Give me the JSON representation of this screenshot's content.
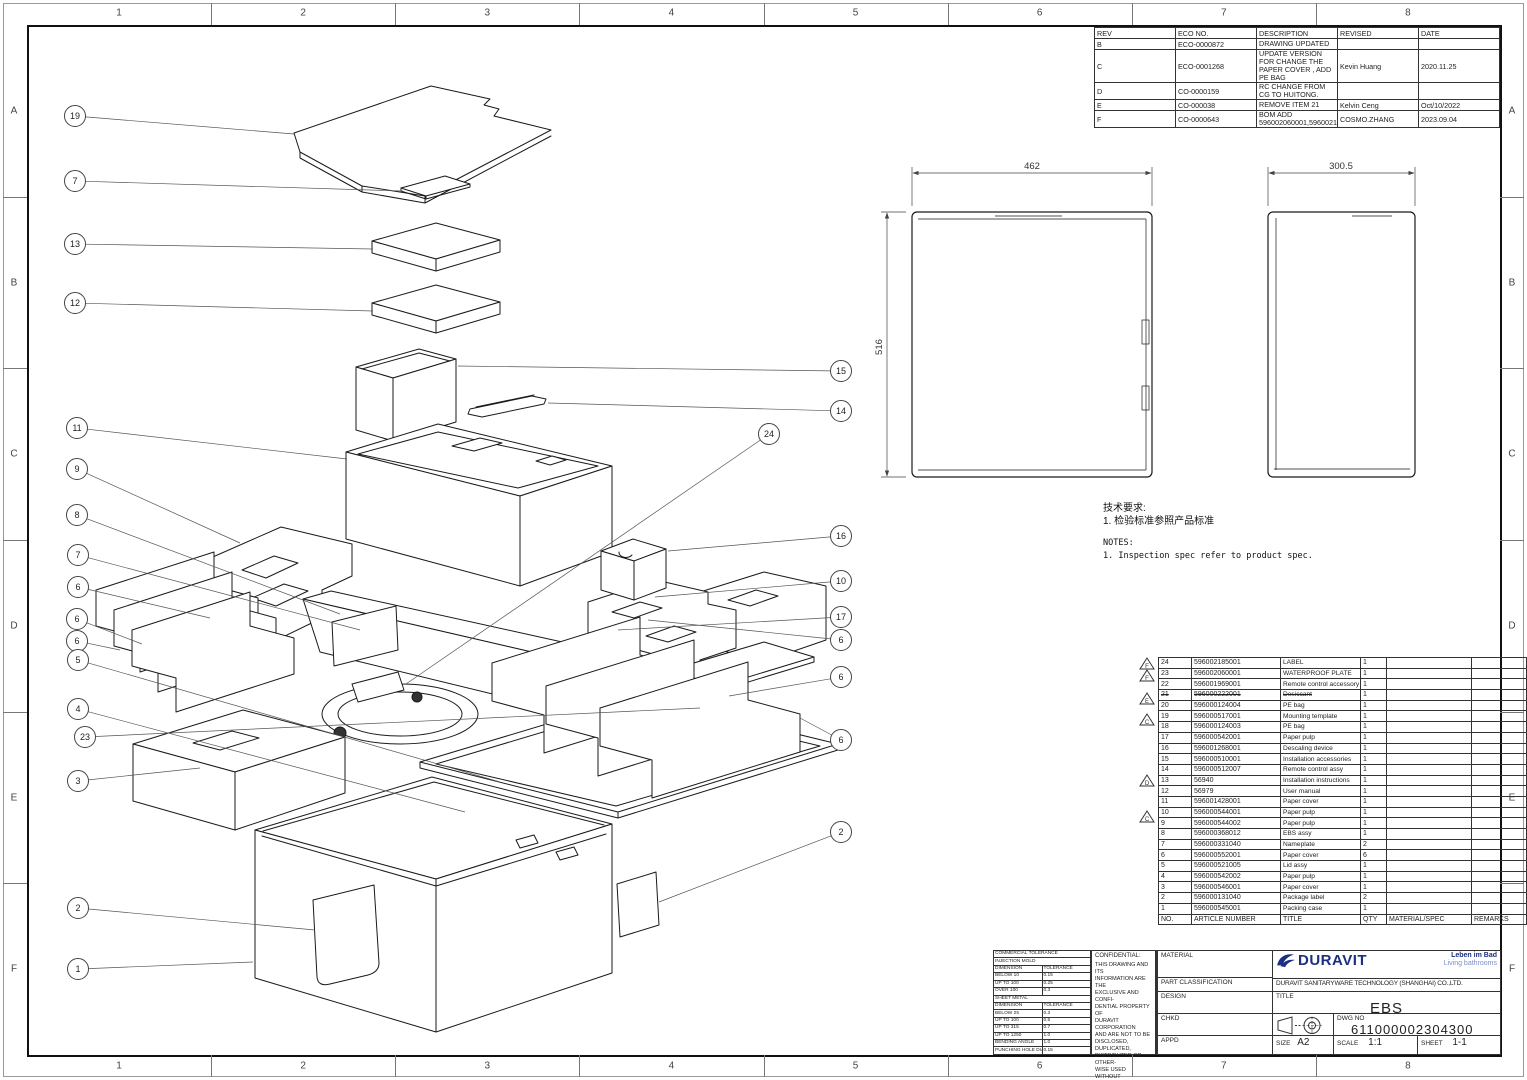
{
  "sheet": {
    "grid": {
      "cols": [
        "1",
        "2",
        "3",
        "4",
        "5",
        "6",
        "7",
        "8"
      ],
      "rows": [
        "A",
        "B",
        "C",
        "D",
        "E",
        "F"
      ]
    },
    "revisions": {
      "headers": [
        "REV",
        "ECO NO.",
        "DESCRIPTION",
        "REVISED",
        "DATE"
      ],
      "rows": [
        [
          "B",
          "ECO-0000872",
          "DRAWING UPDATED",
          "",
          ""
        ],
        [
          "C",
          "ECO-0001268",
          "UPDATE VERSION FOR CHANGE THE PAPER COVER , ADD PE BAG",
          "Kevin Huang",
          "2020.11.25"
        ],
        [
          "D",
          "CO-0000159",
          "RC CHANGE FROM CG TO HUITONG.",
          "",
          ""
        ],
        [
          "E",
          "CO-000038",
          "REMOVE ITEM 21",
          "Kelvin Ceng",
          "Oct/10/2022"
        ],
        [
          "F",
          "CO-0000643",
          "BOM ADD 596002060001,596002185001",
          "COSMO.ZHANG",
          "2023.09.04"
        ]
      ]
    },
    "dims": {
      "front_width": "462",
      "front_height": "516",
      "side_width": "300.5"
    },
    "notes": {
      "cn_title": "技术要求:",
      "cn_1": "1. 检验标准参照产品标准",
      "en_title": "NOTES:",
      "en_1": "1. Inspection spec refer to product spec."
    },
    "bom": {
      "headers": [
        "NO.",
        "ARTICLE NUMBER",
        "TITLE",
        "QTY",
        "MATERIAL/SPEC",
        "REMARKS"
      ],
      "rows": [
        {
          "no": "24",
          "article": "596002185001",
          "title": "LABEL",
          "qty": "1"
        },
        {
          "no": "23",
          "article": "596002060001",
          "title": "WATERPROOF PLATE",
          "qty": "1"
        },
        {
          "no": "22",
          "article": "596001969001",
          "title": "Remote control accessory",
          "qty": "1"
        },
        {
          "no": "21",
          "article": "596000222001",
          "title": "Desiccant",
          "qty": "1",
          "struck": true
        },
        {
          "no": "20",
          "article": "596000124004",
          "title": "PE bag",
          "qty": "1"
        },
        {
          "no": "19",
          "article": "596000517001",
          "title": "Mounting template",
          "qty": "1"
        },
        {
          "no": "18",
          "article": "596000124003",
          "title": "PE bag",
          "qty": "1"
        },
        {
          "no": "17",
          "article": "596000542001",
          "title": "Paper pulp",
          "qty": "1"
        },
        {
          "no": "16",
          "article": "596001268001",
          "title": "Descaling device",
          "qty": "1"
        },
        {
          "no": "15",
          "article": "596000510001",
          "title": "Installation accessories",
          "qty": "1"
        },
        {
          "no": "14",
          "article": "596000512007",
          "title": "Remote control assy",
          "qty": "1"
        },
        {
          "no": "13",
          "article": "56940",
          "title": "Installation instructions",
          "qty": "1"
        },
        {
          "no": "12",
          "article": "56979",
          "title": "User manual",
          "qty": "1"
        },
        {
          "no": "11",
          "article": "596001428001",
          "title": "Paper cover",
          "qty": "1"
        },
        {
          "no": "10",
          "article": "596000544001",
          "title": "Paper pulp",
          "qty": "1"
        },
        {
          "no": "9",
          "article": "596000544002",
          "title": "Paper pulp",
          "qty": "1"
        },
        {
          "no": "8",
          "article": "596000368012",
          "title": "EBS assy",
          "qty": "1"
        },
        {
          "no": "7",
          "article": "596000331040",
          "title": "Nameplate",
          "qty": "2"
        },
        {
          "no": "6",
          "article": "596000552001",
          "title": "Paper cover",
          "qty": "6"
        },
        {
          "no": "5",
          "article": "596000521005",
          "title": "Lid assy",
          "qty": "1"
        },
        {
          "no": "4",
          "article": "596000542002",
          "title": "Paper pulp",
          "qty": "1"
        },
        {
          "no": "3",
          "article": "596000546001",
          "title": "Paper cover",
          "qty": "1"
        },
        {
          "no": "2",
          "article": "596000131040",
          "title": "Package label",
          "qty": "2"
        },
        {
          "no": "1",
          "article": "596000545001",
          "title": "Packing case",
          "qty": "1"
        }
      ]
    },
    "bom_markers": [
      {
        "letter": "F",
        "y": 663
      },
      {
        "letter": "F",
        "y": 675
      },
      {
        "letter": "E",
        "y": 698
      },
      {
        "letter": "C",
        "y": 719
      },
      {
        "letter": "D",
        "y": 780
      },
      {
        "letter": "C",
        "y": 816
      }
    ],
    "tolerance": {
      "title": "COMMERCIAL TOLERANCE",
      "col_headers": [
        "DIMENSION",
        "TOLERANCE"
      ],
      "sections": [
        {
          "name": "INJECTION MOLD",
          "rows": [
            [
              "BELOW 10",
              "0.15"
            ],
            [
              "UP TO 100",
              "0.25"
            ],
            [
              "OVER 100",
              "0.3"
            ]
          ]
        },
        {
          "name": "SHEET METAL",
          "rows": [
            [
              "BELOW 25",
              "0.3"
            ],
            [
              "UP TO 100",
              "0.5"
            ],
            [
              "UP TO 315",
              "0.7"
            ],
            [
              "UP TO 1250",
              "1.0"
            ],
            [
              "BENDING ANGLE",
              "1.0"
            ],
            [
              "PUNCHING HOLE DIA",
              "0.15"
            ]
          ]
        }
      ]
    },
    "confidential": {
      "title": "CONFIDENTIAL:",
      "lines": [
        "THIS DRAWING AND ITS",
        "INFORMATION ARE THE",
        "EXCLUSIVE AND CONFI-",
        "DENTIAL PROPERTY OF",
        "DURAVIT CORPORATION",
        "AND ARE NOT TO BE",
        "DISCLOSED, DUPLICATED,",
        "DISTRIBUTED OR OTHER-",
        "WISE USED WITHOUT",
        "THE WRITTEN CONSENT",
        "OF DURAVIT CORPORA-",
        "TION.",
        "ALL RIGHTS RESERVED."
      ]
    },
    "title_block": {
      "labels": {
        "material": "MATERIAL",
        "part_classification": "PART CLASSIFICATION",
        "design": "DESIGN",
        "chkd": "CHKD",
        "appd": "APPD",
        "title": "TITLE",
        "dwg_no": "DWG NO",
        "size": "SIZE",
        "scale": "SCALE",
        "sheet": "SHEET"
      },
      "brand": {
        "logo": "DURAVIT",
        "tagline1": "Leben im Bad",
        "tagline2": "Living bathrooms",
        "company": "DURAVIT SANITARYWARE TECHNOLOGY (SHANGHAI) CO.,LTD."
      },
      "values": {
        "title": "EBS",
        "dwg_no": "611000002304300",
        "size": "A2",
        "scale": "1:1",
        "sheet": "1-1"
      },
      "colors": {
        "navy": "#1c2f80",
        "light_blue": "#7c90c8"
      }
    },
    "balloons": [
      {
        "n": "19",
        "x": 75,
        "y": 116,
        "tx": 294,
        "ty": 134
      },
      {
        "n": "7",
        "x": 75,
        "y": 181,
        "tx": 403,
        "ty": 191
      },
      {
        "n": "13",
        "x": 75,
        "y": 244,
        "tx": 373,
        "ty": 249
      },
      {
        "n": "12",
        "x": 75,
        "y": 303,
        "tx": 373,
        "ty": 311
      },
      {
        "n": "11",
        "x": 77,
        "y": 428,
        "tx": 347,
        "ty": 459
      },
      {
        "n": "9",
        "x": 77,
        "y": 469,
        "tx": 240,
        "ty": 543
      },
      {
        "n": "8",
        "x": 77,
        "y": 515,
        "tx": 340,
        "ty": 614
      },
      {
        "n": "7",
        "x": 78,
        "y": 555,
        "tx": 360,
        "ty": 630
      },
      {
        "n": "6",
        "x": 78,
        "y": 587,
        "tx": 210,
        "ty": 618
      },
      {
        "n": "6",
        "x": 77,
        "y": 619,
        "tx": 142,
        "ty": 644
      },
      {
        "n": "6",
        "x": 77,
        "y": 641,
        "tx": 120,
        "ty": 650
      },
      {
        "n": "5",
        "x": 78,
        "y": 660,
        "tx": 500,
        "ty": 782
      },
      {
        "n": "4",
        "x": 78,
        "y": 709,
        "tx": 465,
        "ty": 812
      },
      {
        "n": "23",
        "x": 85,
        "y": 737,
        "tx": 700,
        "ty": 708
      },
      {
        "n": "3",
        "x": 78,
        "y": 781,
        "tx": 200,
        "ty": 768
      },
      {
        "n": "2",
        "x": 78,
        "y": 908,
        "tx": 315,
        "ty": 930
      },
      {
        "n": "1",
        "x": 78,
        "y": 969,
        "tx": 253,
        "ty": 962
      },
      {
        "n": "15",
        "x": 841,
        "y": 371,
        "tx": 458,
        "ty": 366
      },
      {
        "n": "14",
        "x": 841,
        "y": 411,
        "tx": 548,
        "ty": 403
      },
      {
        "n": "24",
        "x": 769,
        "y": 434,
        "tx": 406,
        "ty": 684
      },
      {
        "n": "16",
        "x": 841,
        "y": 536,
        "tx": 668,
        "ty": 551
      },
      {
        "n": "10",
        "x": 841,
        "y": 581,
        "tx": 655,
        "ty": 597
      },
      {
        "n": "17",
        "x": 841,
        "y": 617,
        "tx": 618,
        "ty": 630
      },
      {
        "n": "6",
        "x": 841,
        "y": 640,
        "tx": 648,
        "ty": 620
      },
      {
        "n": "6",
        "x": 841,
        "y": 677,
        "tx": 729,
        "ty": 696
      },
      {
        "n": "6",
        "x": 841,
        "y": 740,
        "tx": 800,
        "ty": 718
      },
      {
        "n": "2",
        "x": 841,
        "y": 832,
        "tx": 659,
        "ty": 902
      }
    ]
  }
}
